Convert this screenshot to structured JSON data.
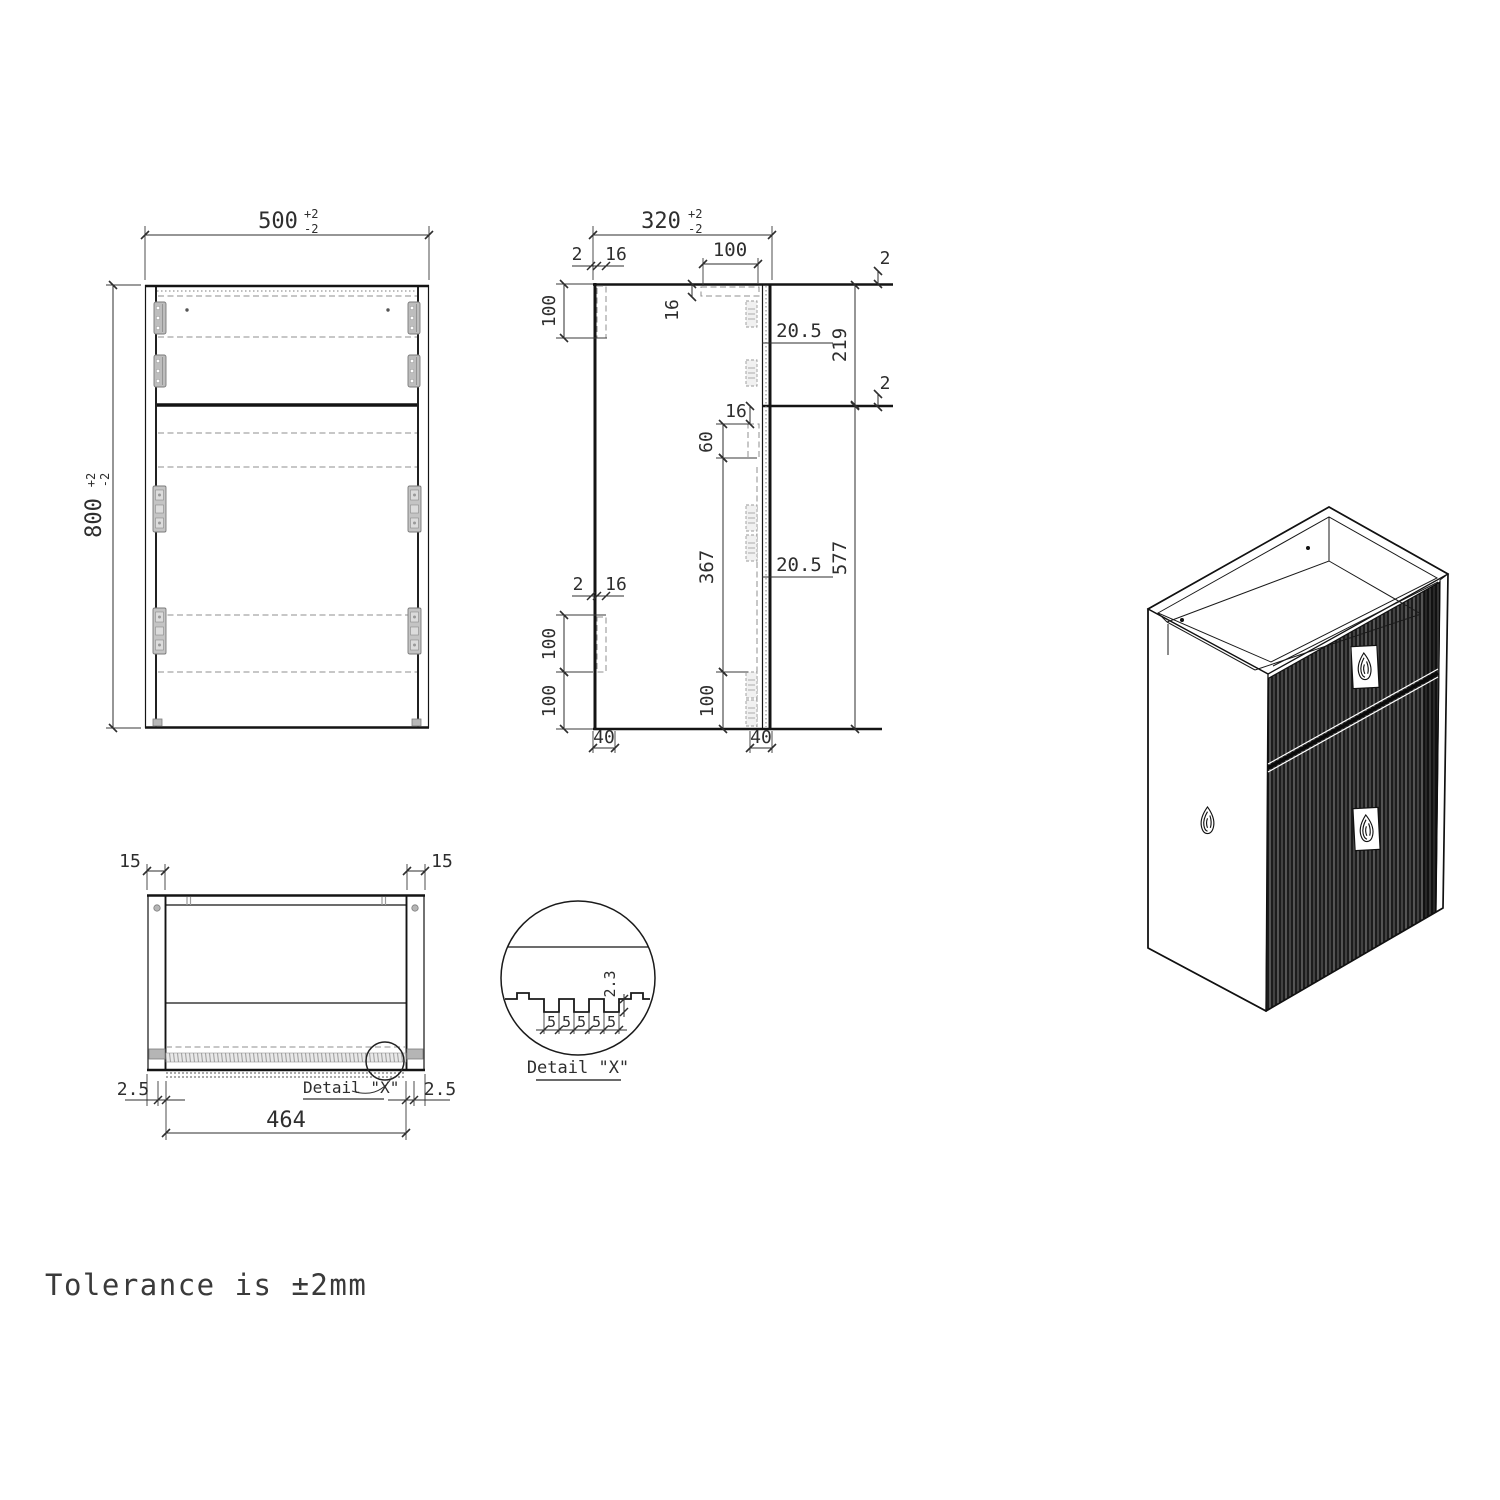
{
  "note": {
    "tolerance": "Tolerance is ±2mm"
  },
  "front_view": {
    "width": {
      "value": "500",
      "tol_up": "+2",
      "tol_dn": "-2"
    },
    "height": {
      "value": "800",
      "tol_up": "+2",
      "tol_dn": "-2"
    }
  },
  "side_view": {
    "depth": {
      "value": "320",
      "tol_up": "+2",
      "tol_dn": "-2"
    },
    "edge_top_left": "2",
    "panel_top_left": "16",
    "back_bracket_top_len": "100",
    "front_bracket_inset": "100",
    "front_bracket_drop": "16",
    "gap_top": "20.5",
    "upper_zone": "219",
    "edge_top_right": "2",
    "edge_mid_right": "2",
    "slide_drop": "16",
    "slide_len": "60",
    "mid_span": "367",
    "gap_bottom": "20.5",
    "lower_zone": "577",
    "edge_bot_left": "2",
    "panel_bot_left": "16",
    "back_bracket_bot_len": "100",
    "back_bracket_bot_off": "100",
    "front_bracket_bot_off": "100",
    "plinth_left": "40",
    "plinth_right": "40"
  },
  "bottom_view": {
    "side_thickness_left": "15",
    "side_thickness_right": "15",
    "gap_left": "2.5",
    "gap_right": "2.5",
    "front_panel_width": "464",
    "detail_callout": "Detail \"X\""
  },
  "detail_view": {
    "title": "Detail \"X\"",
    "flute_depth": "2.3",
    "flute_pitch": [
      "5",
      "5",
      "5",
      "5",
      "5"
    ]
  }
}
